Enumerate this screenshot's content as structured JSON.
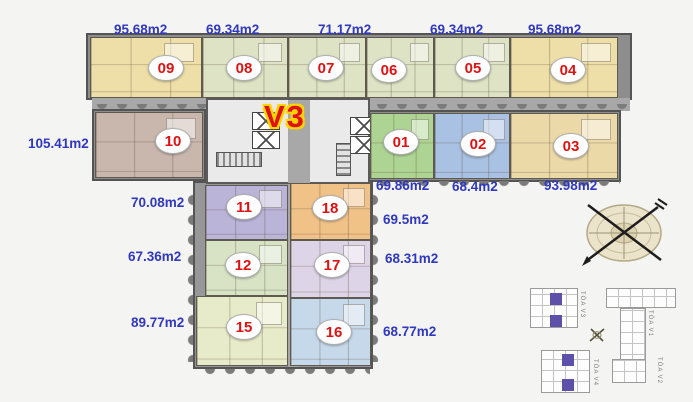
{
  "title": {
    "text": "V3",
    "color": "#e01111",
    "outline_color": "#ffd400"
  },
  "units": [
    {
      "num": "09",
      "area": "95.68m2",
      "fill": "#eedfa8"
    },
    {
      "num": "08",
      "area": "69.34m2",
      "fill": "#dde3c4"
    },
    {
      "num": "07",
      "area": "71.17m2",
      "fill": "#dde3c4"
    },
    {
      "num": "06",
      "area": null,
      "fill": "#dde3c4"
    },
    {
      "num": "05",
      "area": "69.34m2",
      "fill": "#dde3c4"
    },
    {
      "num": "04",
      "area": "95.68m2",
      "fill": "#eedfa8"
    },
    {
      "num": "10",
      "area": "105.41m2",
      "fill": "#c9b7ae"
    },
    {
      "num": "01",
      "area": "69.86m2",
      "fill": "#aed494"
    },
    {
      "num": "02",
      "area": "68.4m2",
      "fill": "#a9c1e2"
    },
    {
      "num": "03",
      "area": "93.98m2",
      "fill": "#ecd9a8"
    },
    {
      "num": "11",
      "area": "70.08m2",
      "fill": "#bab4d8"
    },
    {
      "num": "12",
      "area": "67.36m2",
      "fill": "#d7e3c4"
    },
    {
      "num": "15",
      "area": "89.77m2",
      "fill": "#e8ebc9"
    },
    {
      "num": "18",
      "area": "69.5m2",
      "fill": "#f0c288"
    },
    {
      "num": "17",
      "area": "68.31m2",
      "fill": "#ded4e7"
    },
    {
      "num": "16",
      "area": "68.77m2",
      "fill": "#c6d9ea"
    }
  ],
  "styles": {
    "area_label_color": "#3038c0",
    "unit_number_color": "#e01111",
    "corridor_color": "#a8a8a8",
    "wall_color": "#545454",
    "highlight_purple": "#5c50a8"
  },
  "icons": {
    "compass": "compass-rose-icon",
    "mini_compass": "mini-compass-icon"
  },
  "site_map": {
    "buildings": [
      {
        "label": "TÒA V3",
        "highlighted": true
      },
      {
        "label": "TÒA V4",
        "highlighted": true
      },
      {
        "label": "TÒA V1",
        "highlighted": false
      },
      {
        "label": "TÒA V2",
        "highlighted": false
      }
    ]
  }
}
